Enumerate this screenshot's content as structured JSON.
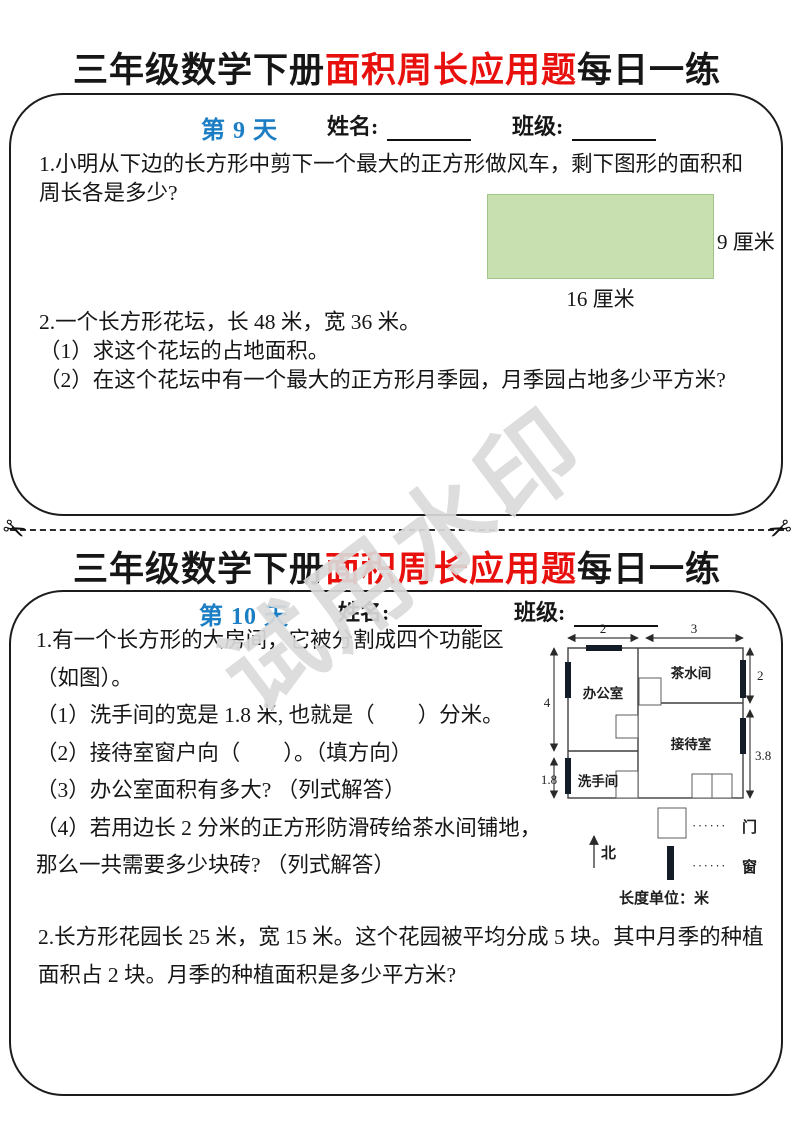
{
  "title": {
    "part1": "三年级数学下册",
    "part2": "面积周长应用题",
    "part3": "每日一练"
  },
  "watermark": {
    "text": "试用水印"
  },
  "colors": {
    "accent_red": "#e8100c",
    "accent_blue": "#1b7ec5",
    "figure_green": "#c8dfb0"
  },
  "section1": {
    "day_label": "第 9 天",
    "name_label": "姓名:",
    "class_label": "班级:",
    "problem1": {
      "text": "1.小明从下边的长方形中剪下一个最大的正方形做风车，剩下图形的面积和周长各是多少?",
      "figure": {
        "height_label": "9 厘米",
        "width_label": "16 厘米"
      }
    },
    "problem2": {
      "intro": "2.一个长方形花坛，长 48 米，宽 36 米。",
      "q1": "（1）求这个花坛的占地面积。",
      "q2": "（2）在这个花坛中有一个最大的正方形月季园，月季园占地多少平方米?"
    }
  },
  "section2": {
    "day_label": "第 10 天",
    "name_label": "姓名:",
    "class_label": "班级:",
    "problem1": {
      "intro": "1.有一个长方形的大房间，它被分割成四个功能区（如图）。",
      "q1": "（1）洗手间的宽是 1.8 米, 也就是（　　）分米。",
      "q2": "（2）接待室窗户向（　　）。（填方向）",
      "q3": "（3）办公室面积有多大? （列式解答）",
      "q4": "（4）若用边长 2 分米的正方形防滑砖给茶水间铺地，那么一共需要多少块砖? （列式解答）"
    },
    "floorplan": {
      "rooms": {
        "office": "办公室",
        "tea": "茶水间",
        "reception": "接待室",
        "washroom": "洗手间"
      },
      "dims": {
        "top_left": "2",
        "top_right": "3",
        "left_upper": "4",
        "left_lower": "1.8",
        "right_upper": "2",
        "right_lower": "3.8"
      },
      "north_label": "北",
      "legend": {
        "dots": "······",
        "door": "门",
        "window": "窗",
        "unit": "长度单位：米"
      }
    },
    "problem2": {
      "text": "2.长方形花园长 25 米，宽 15 米。这个花园被平均分成 5 块。其中月季的种植面积占 2 块。月季的种植面积是多少平方米?"
    }
  }
}
